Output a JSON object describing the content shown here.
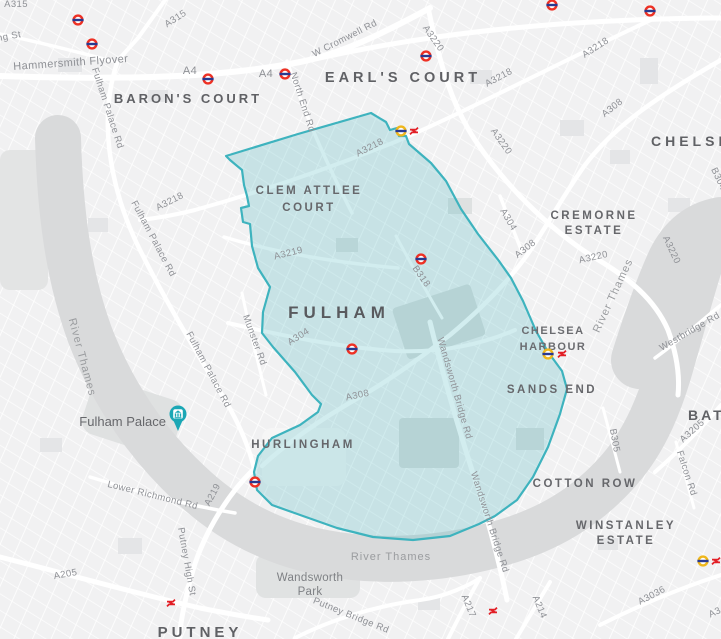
{
  "map": {
    "description_visible_area": "Fulham, London with highlighted boundary region",
    "colors": {
      "land": "#f1f1f2",
      "river": "#d9dadb",
      "park": "#e1e3e3",
      "highlight_fill": "#4db6c0",
      "highlight_stroke": "#3eb3be",
      "district_label": "#66676b",
      "road_label": "#8f9196",
      "underground_red": "#ee3124",
      "roundel_bar_blue": "#29398f",
      "interchange_yellow": "#efb71c",
      "national_rail_red": "#e21f26",
      "poi_pin_teal": "#1ba7b5"
    },
    "icons": {
      "underground_station": "underground-roundel-icon",
      "interchange_station": "interchange-roundel-icon",
      "national_rail": "national-rail-icon",
      "poi_pin": "museum-pin-icon"
    }
  },
  "region": {
    "name": "Fulham highlighted area",
    "fill": "#4db6c0",
    "stroke": "#3eb3be"
  },
  "districts": {
    "barons_court": "BARON'S COURT",
    "earls_court": "EARL'S COURT",
    "chelsea": "CHELSEA",
    "clem_attlee_1": "CLEM ATTLEE",
    "clem_attlee_2": "COURT",
    "cremorne_1": "CREMORNE",
    "cremorne_2": "ESTATE",
    "fulham": "FULHAM",
    "chelsea_harbour_1": "CHELSEA",
    "chelsea_harbour_2": "HARBOUR",
    "sands_end": "SANDS END",
    "hurlingham": "HURLINGHAM",
    "cotton_row": "COTTON ROW",
    "winstanley_1": "WINSTANLEY",
    "winstanley_2": "ESTATE",
    "battersea": "BATTERSEA",
    "putney": "PUTNEY",
    "wandsworth_park_1": "Wandsworth",
    "wandsworth_park_2": "Park"
  },
  "poi": {
    "fulham_palace": "Fulham Palace"
  },
  "water": {
    "river_thames_west": "River Thames",
    "river_thames_east": "River Thames",
    "river_thames_south": "River Thames"
  },
  "roads": {
    "a315_top": "A315",
    "a315_badge": "A315",
    "king_st": "King St",
    "hammersmith_flyover": "Hammersmith Flyover",
    "a4_west": "A4",
    "a4_east": "A4",
    "w_cromwell_rd": "W Cromwell Rd",
    "north_end_rd": "North End Rd",
    "a3220_warwick": "A3220",
    "a3218_chelsea": "A3218",
    "a308_chelsea": "A308",
    "a3218_earls": "A3218",
    "a3220_kings": "A3220",
    "a3218_fulham": "A3218",
    "a3218_lillie": "A3218",
    "b304": "B304",
    "a3220_battersea_w": "A3220",
    "a3220_battersea_e": "A3220",
    "a304_kings": "A304",
    "a308_cremorne": "A308",
    "a3219": "A3219",
    "b318": "B318",
    "a304_fulham": "A304",
    "munster_rd": "Munster Rd",
    "fulham_palace_rd_n": "Fulham Palace Rd",
    "fulham_palace_rd_m": "Fulham Palace Rd",
    "fulham_palace_rd_s": "Fulham Palace Rd",
    "wandsworth_bridge_rd_n": "Wandsworth Bridge Rd",
    "wandsworth_bridge_rd_s": "Wandsworth Bridge Rd",
    "a308_new_kings": "A308",
    "lower_richmond_rd": "Lower Richmond Rd",
    "a219": "A219",
    "putney_high_st": "Putney High St",
    "a205": "A205",
    "putney_bridge_rd": "Putney Bridge Rd",
    "a217": "A217",
    "a214": "A214",
    "a3036": "A3036",
    "b305": "B305",
    "a3205": "A3205",
    "falcon_rd": "Falcon Rd",
    "westbridge_rd": "Westbridge Rd",
    "a3_clipped": "A3"
  }
}
